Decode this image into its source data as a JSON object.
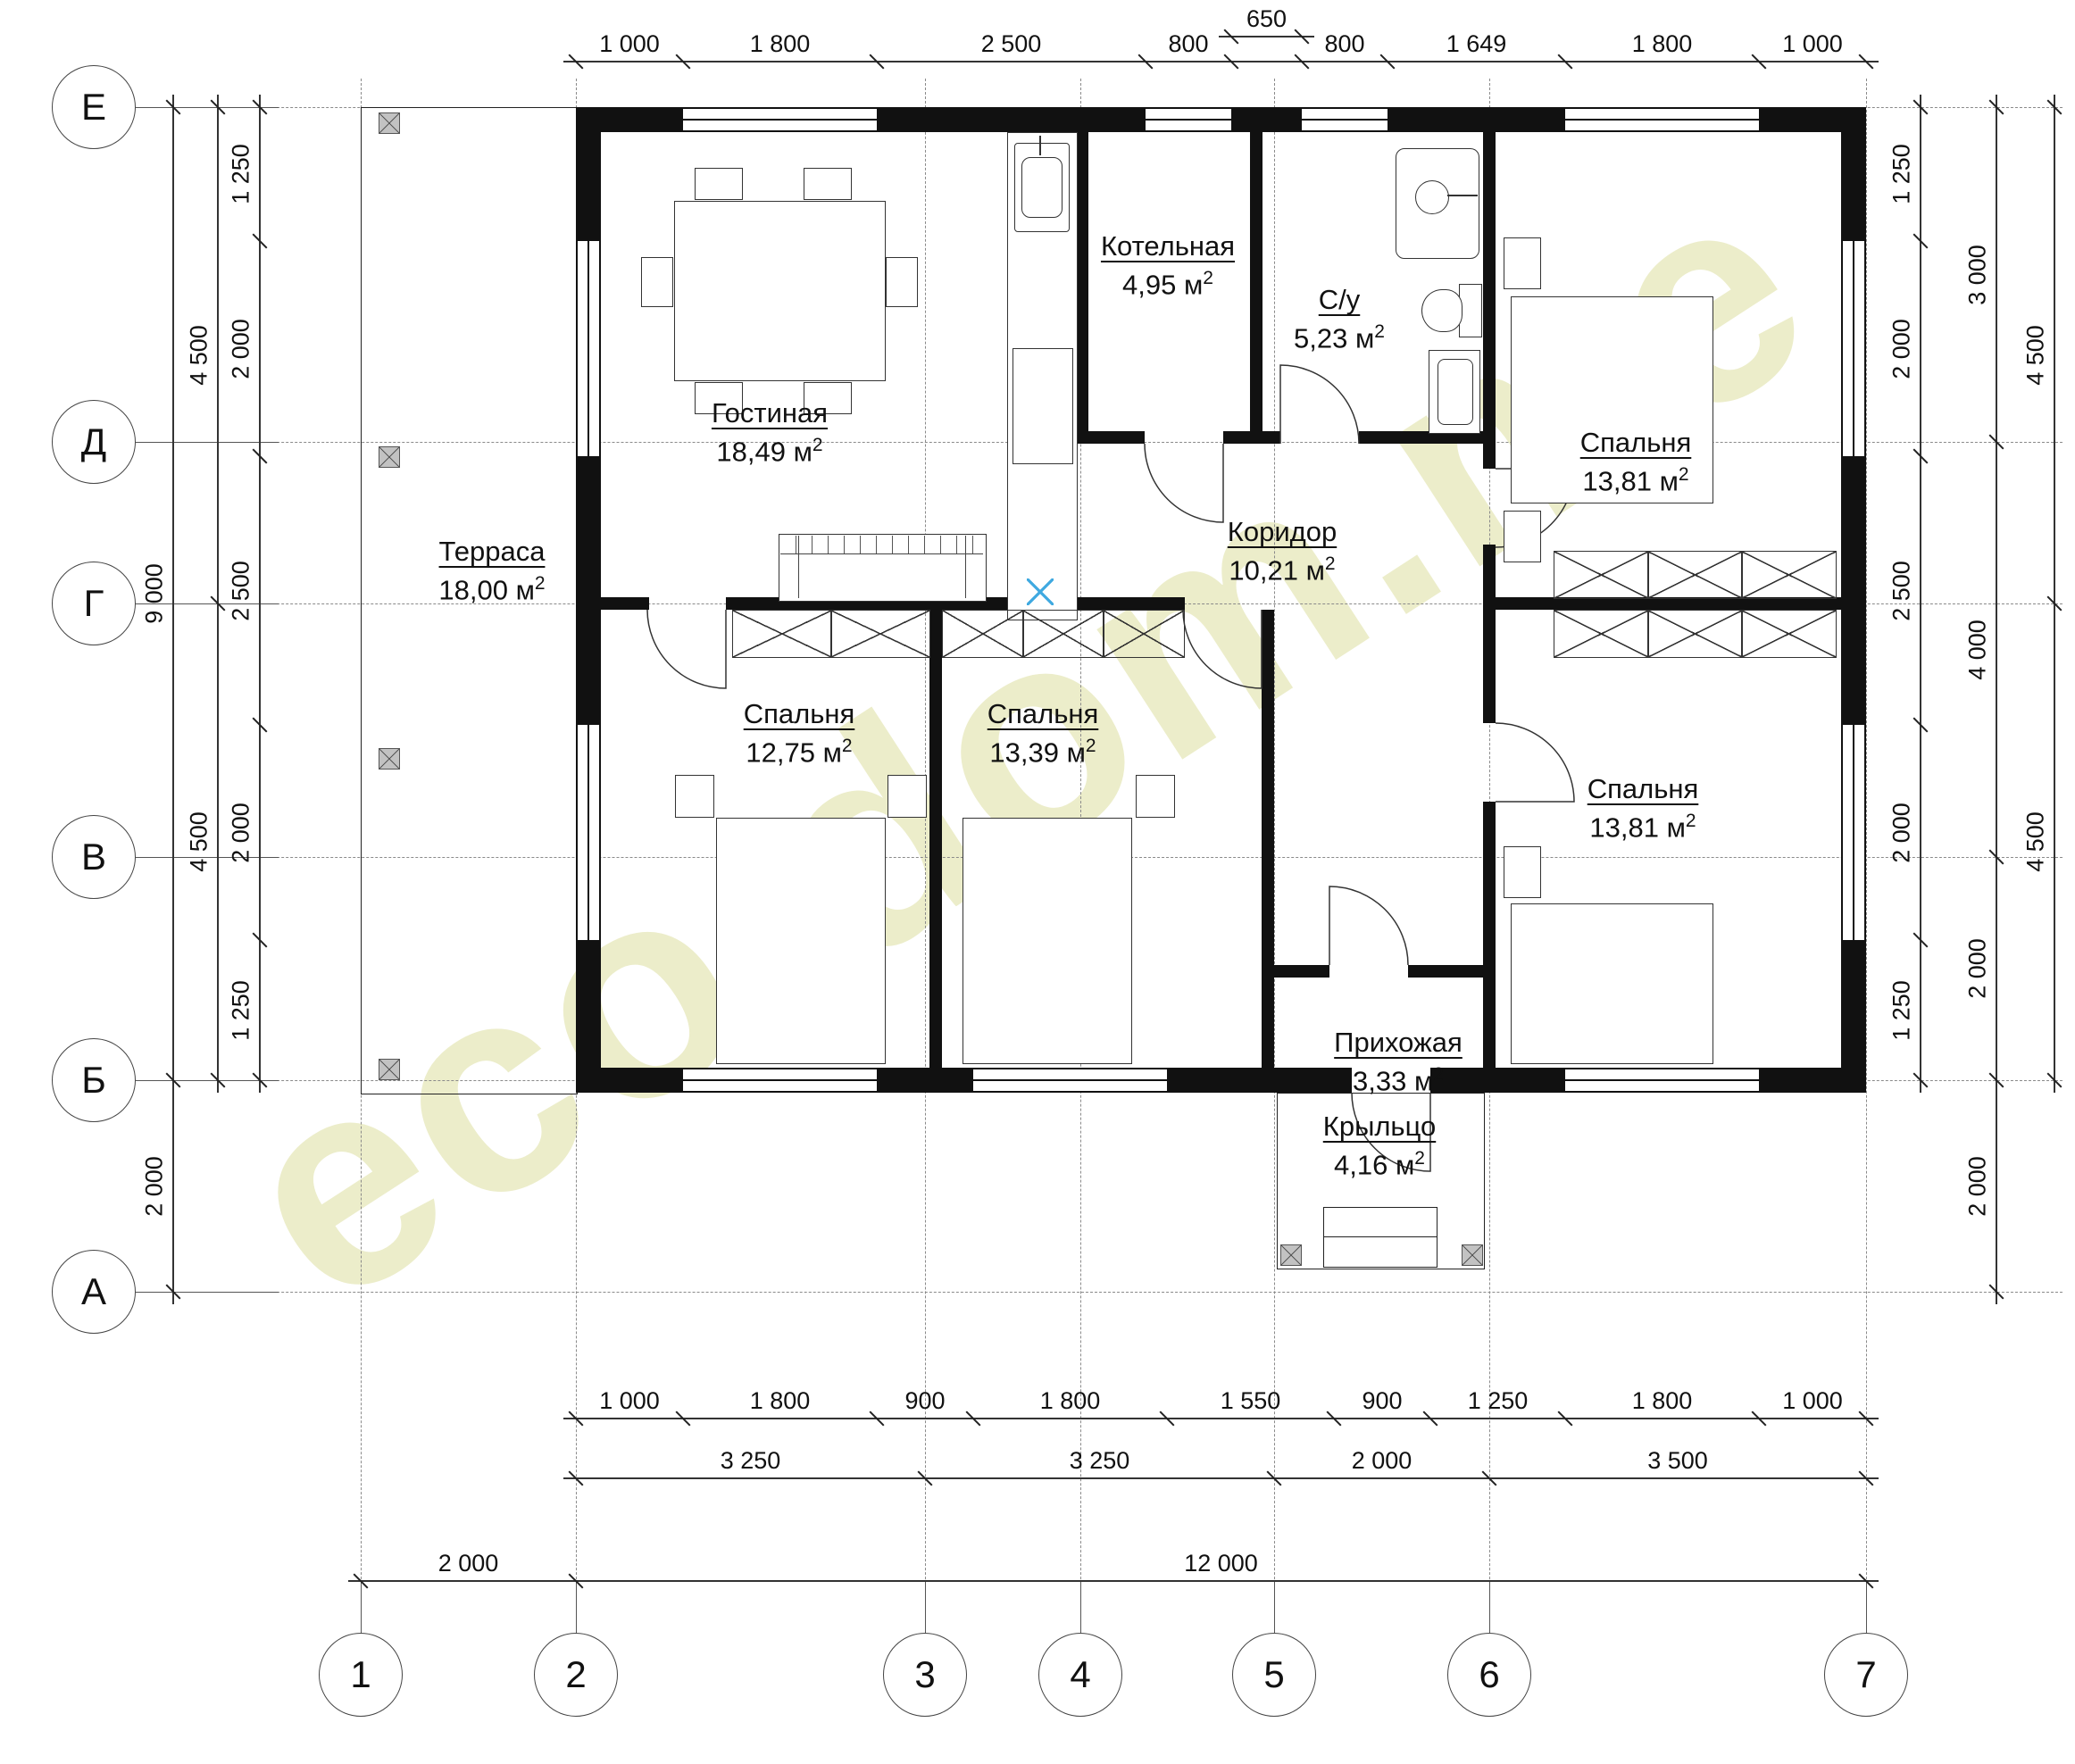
{
  "meta": {
    "unit_base": "м",
    "unit_sup": "2",
    "watermark": "eco-dom.me"
  },
  "axes": {
    "rows": [
      "Е",
      "Д",
      "Г",
      "В",
      "Б",
      "А"
    ],
    "cols": [
      "1",
      "2",
      "3",
      "4",
      "5",
      "6",
      "7"
    ]
  },
  "dims": {
    "top": [
      "1 000",
      "1 800",
      "2 500",
      "800",
      "",
      "800",
      "1 649",
      "1 800",
      "1 000"
    ],
    "top_offset": [
      "650"
    ],
    "bottom_windows": [
      "1 000",
      "1 800",
      "900",
      "1 800",
      "1 550",
      "900",
      "1 250",
      "1 800",
      "1 000"
    ],
    "bottom_axes": [
      "3 250",
      "3 250",
      "2 000",
      "3 500"
    ],
    "bottom_overall": [
      "2 000",
      "12 000"
    ],
    "left_overall": [
      "9 000",
      "2 000"
    ],
    "left_axes": [
      "4 500",
      "4 500"
    ],
    "left_windows": [
      "1 250",
      "2 000",
      "2 500",
      "2 000",
      "1 250"
    ],
    "right_windows": [
      "1 250",
      "2 000",
      "2 500",
      "2 000",
      "1 250"
    ],
    "right_axes": [
      "3 000",
      "4 000",
      "2 000",
      "2 000"
    ],
    "right_overall": [
      "4 500",
      "4 500"
    ]
  },
  "rooms": {
    "terrace": {
      "name": "Терраса",
      "area": "18,00"
    },
    "living": {
      "name": "Гостиная",
      "area": "18,49"
    },
    "boiler": {
      "name": "Котельная",
      "area": "4,95"
    },
    "bathroom": {
      "name": "С/у",
      "area": "5,23"
    },
    "bedroom_tr": {
      "name": "Спальня",
      "area": "13,81"
    },
    "corridor": {
      "name": "Коридор",
      "area": "10,21"
    },
    "bedroom_bl": {
      "name": "Спальня",
      "area": "12,75"
    },
    "bedroom_bm": {
      "name": "Спальня",
      "area": "13,39"
    },
    "bedroom_br": {
      "name": "Спальня",
      "area": "13,81"
    },
    "hallway": {
      "name": "Прихожая",
      "area": "3,33"
    },
    "porch": {
      "name": "Крыльцо",
      "area": "4,16"
    }
  }
}
